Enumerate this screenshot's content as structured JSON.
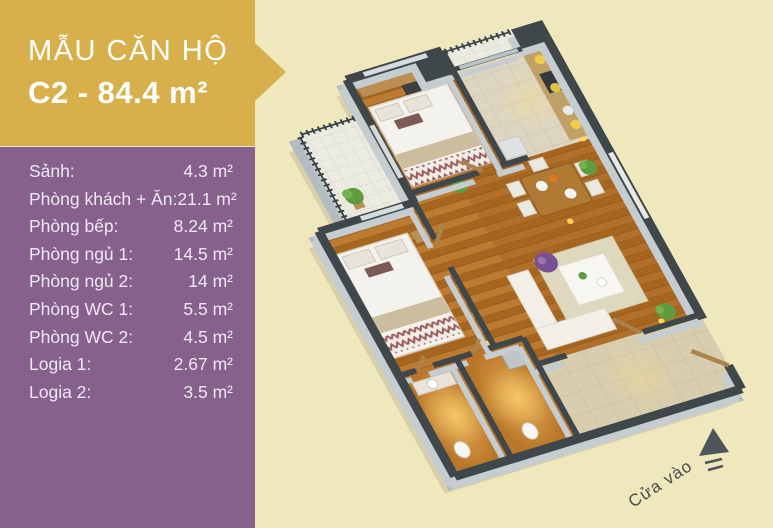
{
  "banner": {
    "line1": "MẪU CĂN HỘ",
    "line2": "C2 - 84.4 m²"
  },
  "rooms": [
    {
      "label": "Sảnh:",
      "value": "4.3 m²"
    },
    {
      "label": "Phòng khách + Ăn:",
      "value": "21.1 m²"
    },
    {
      "label": "Phòng bếp:",
      "value": "8.24 m²"
    },
    {
      "label": "Phòng ngủ 1:",
      "value": "14.5 m²"
    },
    {
      "label": "Phòng ngủ 2:",
      "value": "14 m²"
    },
    {
      "label": "Phòng WC 1:",
      "value": "5.5 m²"
    },
    {
      "label": "Phòng WC 2:",
      "value": "4.5 m²"
    },
    {
      "label": "Logia 1:",
      "value": "2.67 m²"
    },
    {
      "label": "Logia 2:",
      "value": "3.5 m²"
    }
  ],
  "floorplan": {
    "entrance_label": "Cửa vào"
  },
  "colors": {
    "banner_gold": "#d7b04b",
    "panel_purple": "#86618b",
    "background_cream": "#f0e8bd",
    "wall_dark": "#3f474b",
    "wall_light": "#c6cdd0",
    "floor_wood": "#b06f2a",
    "wc_orange": "#cf8a35",
    "pouf_purple": "#7b4f93",
    "text_white": "#ffffff"
  }
}
